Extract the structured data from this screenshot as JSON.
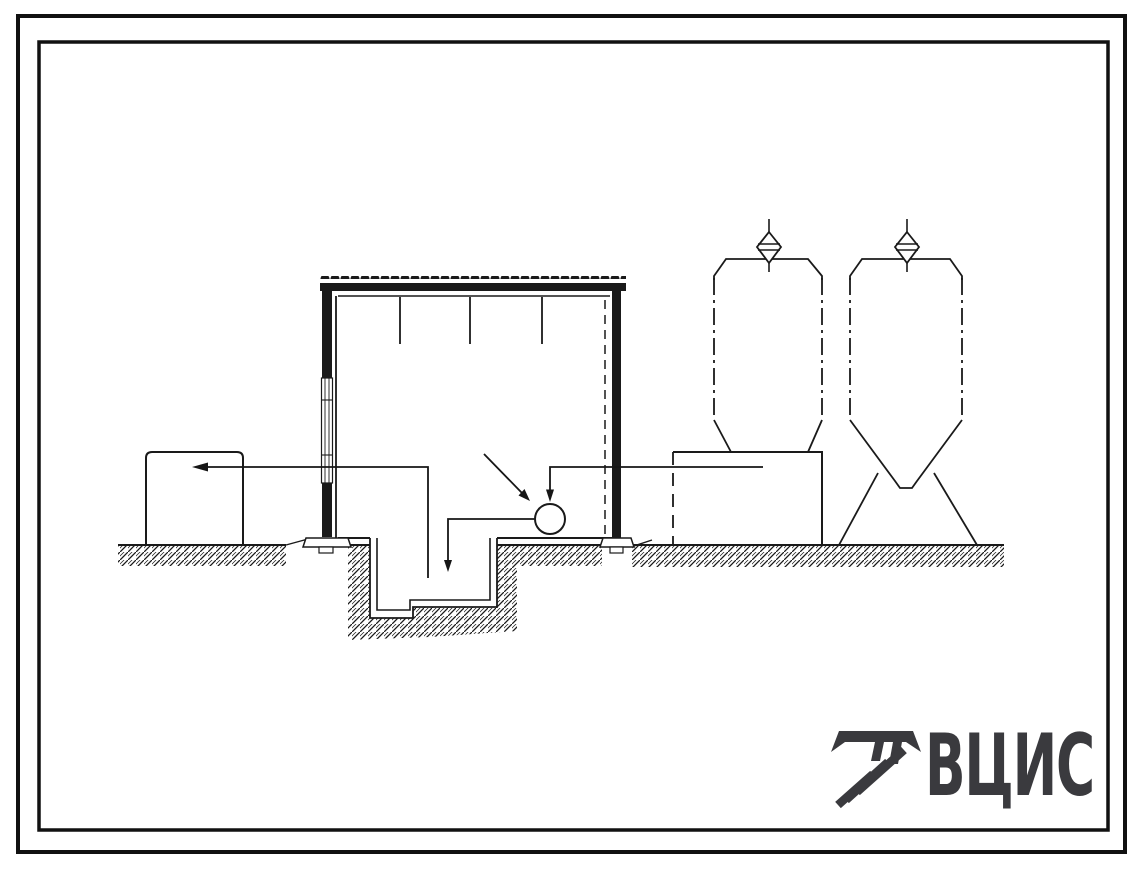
{
  "sheet": {
    "paper_color": "#ffffff",
    "ink_color": "#1a1a1a",
    "border": {
      "outer": "double-frame",
      "inner": "double-frame"
    }
  },
  "drawing": {
    "kind": "building cross-section with process equipment",
    "elements": [
      "building-cross-section",
      "corrugated-roof",
      "left-wall-with-window-strip",
      "right-wall-with-dashed-inner-line",
      "interior-hanger-lines",
      "pump-circle",
      "flow-pipes-with-arrows",
      "annotation-arrow",
      "underground-pit-sump",
      "earth-hatching",
      "storage-tank-left",
      "equipment-box-right",
      "silo-left",
      "silo-right",
      "silo-vent-left",
      "silo-vent-right",
      "silo-support-legs"
    ]
  },
  "logo": {
    "text": "ВЦИС",
    "color": "#3a3a3e",
    "mark": "striped-sha-emblem"
  }
}
